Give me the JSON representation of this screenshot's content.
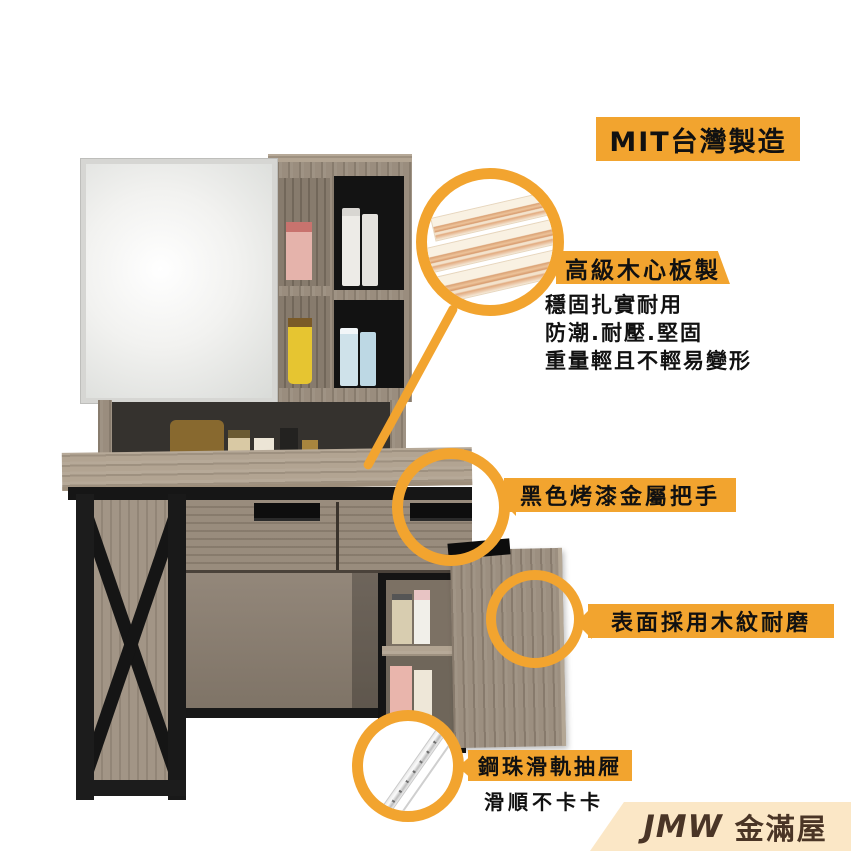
{
  "badge": {
    "label": "MIT台灣製造"
  },
  "callouts": [
    {
      "label": "高級木心板製",
      "details": [
        "穩固扎實耐用",
        "防潮.耐壓.堅固",
        "重量輕且不輕易變形"
      ],
      "graphic": "plywood-boards"
    },
    {
      "label": "黑色烤漆金屬把手",
      "graphic": "drawer-handle-zoom"
    },
    {
      "label": "表面採用木紋耐磨",
      "graphic": "wood-grain-surface-zoom"
    },
    {
      "label": "鋼珠滑軌抽屜",
      "details": [
        "滑順不卡卡"
      ],
      "graphic": "ball-bearing-slide-rail"
    }
  ],
  "brand": {
    "name_en": "JMW",
    "name_zh": "金滿屋"
  },
  "colors": {
    "accent": "#F2A42F",
    "brand_band": "#FBE7C6",
    "brand_text": "#4A3526",
    "text": "#111111"
  }
}
